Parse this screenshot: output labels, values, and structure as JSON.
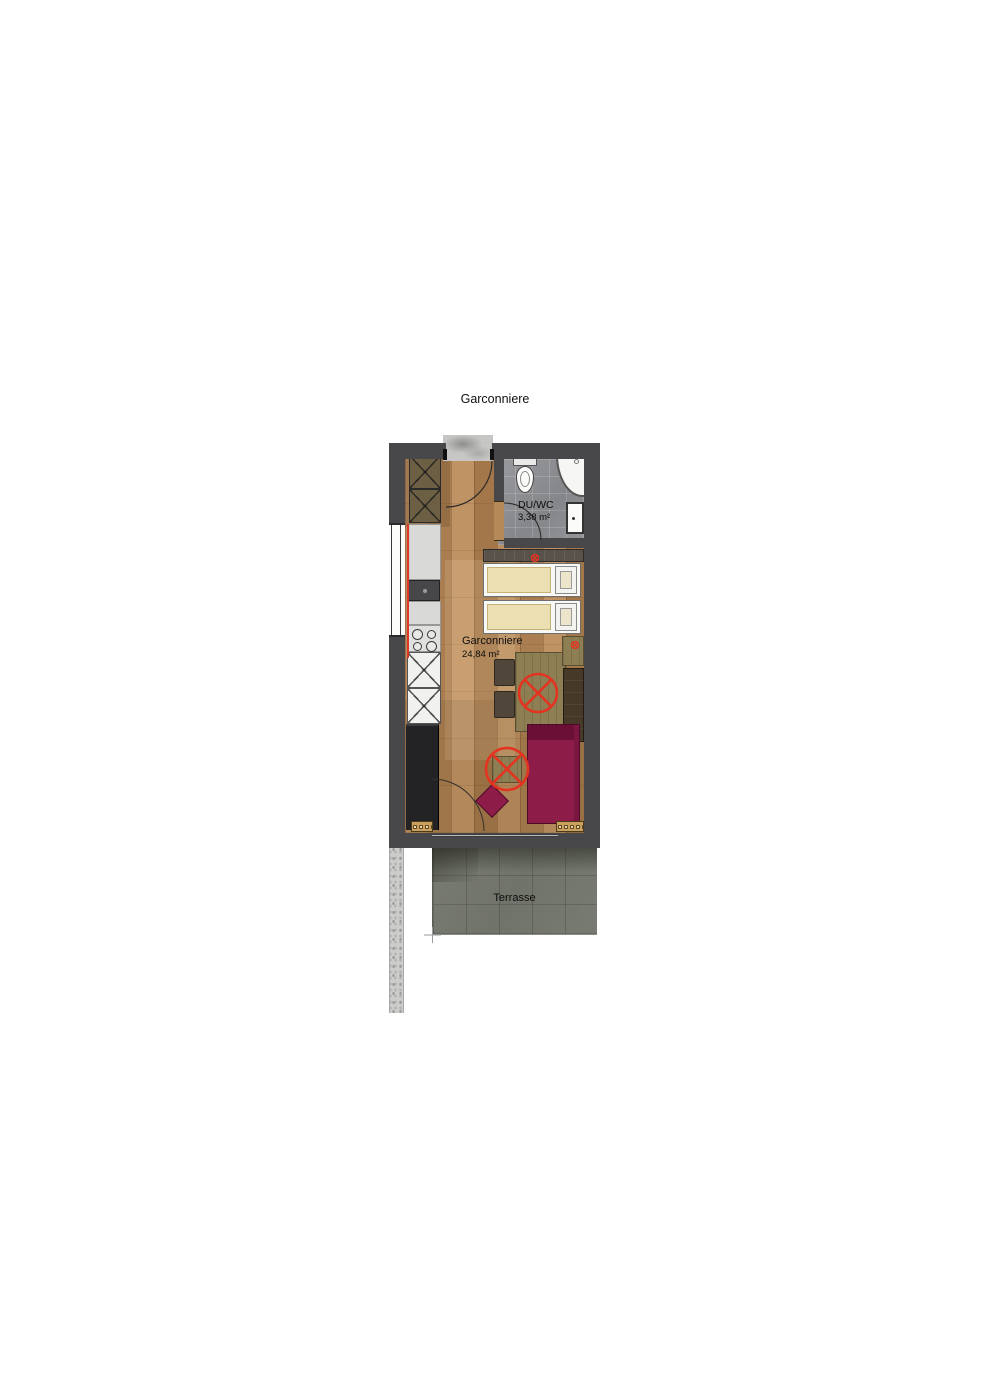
{
  "page": {
    "title": "Garconniere"
  },
  "plan": {
    "room": {
      "name": "Garconniere",
      "area": "24,84 m²"
    },
    "bathroom": {
      "name": "DU/WC",
      "area": "3,38 m²"
    },
    "terrace": {
      "name": "Terrasse"
    },
    "colors": {
      "wall": "#48484a",
      "wood": "#b1855a",
      "bathroom_tile": "#8f9094",
      "terrace": "#74776d",
      "sofa": "#8e1c49",
      "accent_red": "#e23420",
      "mattress": "#ecdfb2",
      "kitchen_counter": "#d9d9d7",
      "olive_wood": "#8d7e54"
    },
    "symbols": {
      "circle_cross": "ceiling-outlet-symbol",
      "arc": "door-swing-arc"
    }
  }
}
